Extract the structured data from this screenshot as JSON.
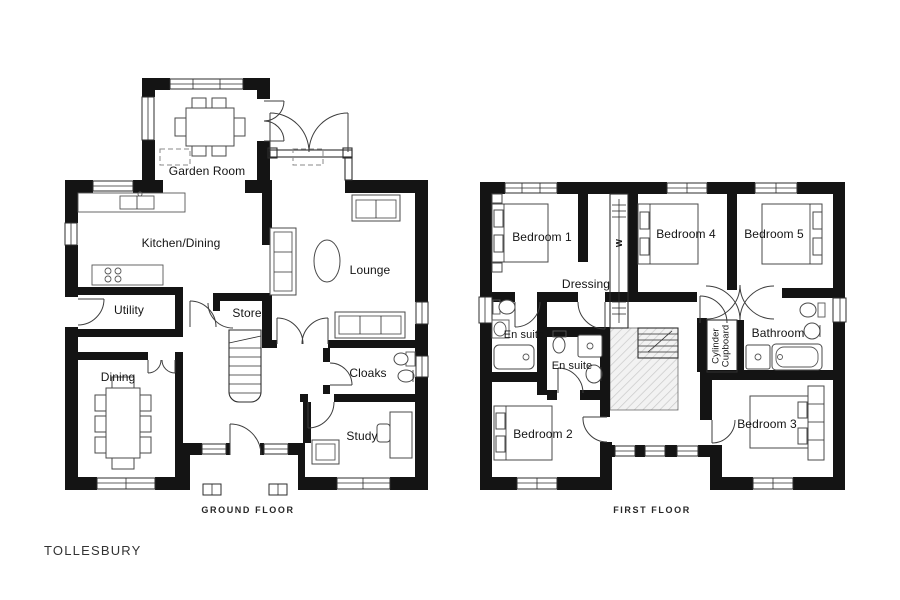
{
  "title": "TOLLESBURY",
  "ground_floor": {
    "caption": "GROUND FLOOR",
    "rooms": {
      "garden_room": "Garden Room",
      "kitchen_dining": "Kitchen/Dining",
      "lounge": "Lounge",
      "utility": "Utility",
      "store": "Store",
      "dining": "Dining",
      "cloaks": "Cloaks",
      "study": "Study"
    }
  },
  "first_floor": {
    "caption": "FIRST FLOOR",
    "rooms": {
      "bedroom_1": "Bedroom 1",
      "dressing": "Dressing",
      "wardrobe": "W",
      "bedroom_4": "Bedroom 4",
      "bedroom_5": "Bedroom 5",
      "en_suite_1": "En suite",
      "en_suite_2": "En suite",
      "bathroom": "Bathroom",
      "cylinder_cupboard": "Cylinder\nCupboard",
      "bedroom_2": "Bedroom 2",
      "bedroom_3": "Bedroom 3"
    }
  },
  "colors": {
    "walls": "#141414",
    "background": "#ffffff",
    "hatch": "#c9c9c9"
  }
}
